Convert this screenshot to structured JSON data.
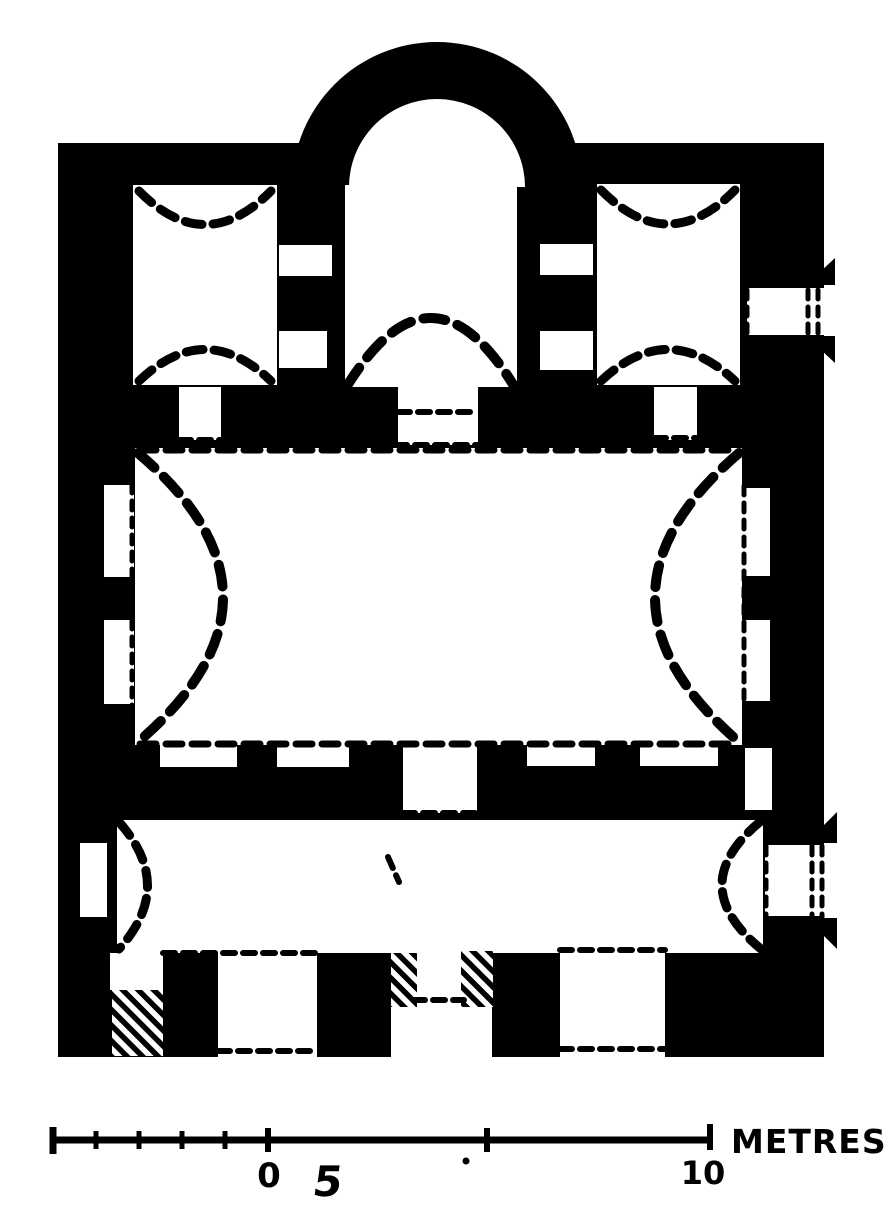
{
  "figure": {
    "type": "architectural-floor-plan",
    "description": "Black-and-white ground plan of a small single-apse church: apse at top, three sanctuary bays, large vaulted naos, narthex, south facade with doorways; hatched patches mark altered masonry.",
    "ink_color": "#000000",
    "paper_color": "#ffffff"
  },
  "scale_bar": {
    "unit_label": "METRES",
    "tick_labels": [
      "5",
      "0",
      "5",
      "10"
    ],
    "ticks_metres": [
      -5,
      0,
      5,
      10
    ],
    "minor_tick_interval_metres": 1
  }
}
